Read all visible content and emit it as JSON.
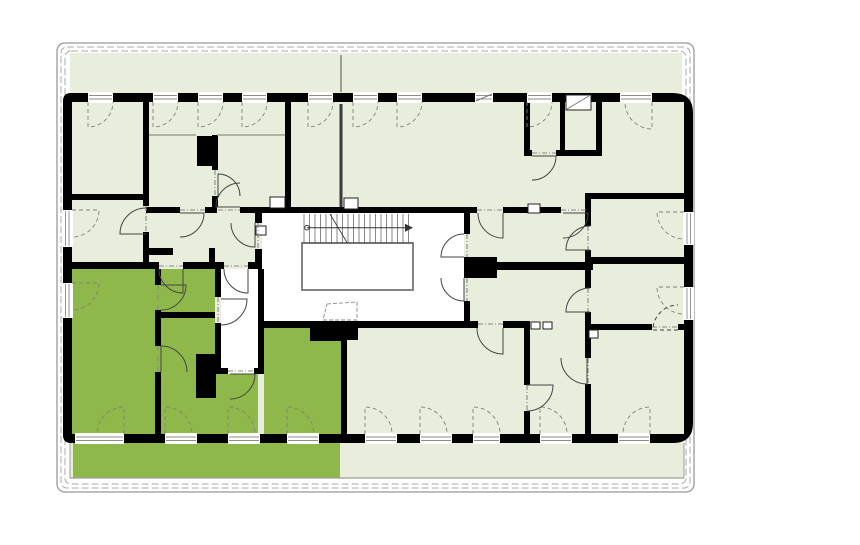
{
  "plan": {
    "canvas": {
      "w": 860,
      "h": 545
    },
    "colors": {
      "page_bg": "#ffffff",
      "room_fill": "#e9eedc",
      "highlight_fill": "#8fb84a",
      "wall": "#000000",
      "outline_gray": "#999999",
      "dash_gray": "#aaaaaa",
      "line_dark": "#444444",
      "window_arc": "#808080",
      "sill_gray": "#8a8a8a",
      "stair_line": "#555555",
      "well_stroke": "#777777",
      "terrace_line": "#9aa08f"
    },
    "outline": {
      "x": 57,
      "y": 43,
      "w": 637,
      "h": 449,
      "r": 8,
      "insets": [
        4,
        8
      ]
    },
    "bands": {
      "top": {
        "x": 70,
        "y": 53,
        "w": 612,
        "h": 40
      },
      "bottom": {
        "x": 70,
        "y": 443,
        "w": 614,
        "h": 35
      },
      "highlight_terrace": {
        "x": 73,
        "y": 443,
        "w": 267,
        "h": 35
      }
    },
    "shell": {
      "outer": {
        "x": 63,
        "y": 93,
        "w": 630,
        "h": 350,
        "r_left": 8,
        "r_right": 20
      },
      "inner": {
        "x": 72,
        "y": 102,
        "w": 612,
        "h": 332
      }
    },
    "white_regions": [
      [
        262,
        213,
        202,
        108
      ],
      [
        221,
        269,
        37,
        105
      ],
      [
        200,
        139,
        13,
        24
      ],
      [
        200,
        358,
        12,
        36
      ],
      [
        313,
        331,
        10,
        8
      ],
      [
        327,
        331,
        10,
        8
      ],
      [
        344,
        330,
        11,
        8
      ]
    ],
    "highlight_regions": [
      [
        72,
        269,
        143,
        165
      ],
      [
        215,
        374,
        43,
        60
      ],
      [
        264,
        328,
        77,
        106
      ]
    ],
    "walls": [
      [
        143,
        102,
        6,
        104
      ],
      [
        143,
        232,
        6,
        37
      ],
      [
        72,
        194,
        77,
        6
      ],
      [
        143,
        248,
        30,
        7
      ],
      [
        212,
        135,
        6,
        35
      ],
      [
        212,
        196,
        6,
        11
      ],
      [
        197,
        136,
        20,
        30
      ],
      [
        285,
        102,
        6,
        111
      ],
      [
        146,
        207,
        34,
        6
      ],
      [
        205,
        207,
        12,
        6
      ],
      [
        240,
        207,
        230,
        6
      ],
      [
        255,
        213,
        7,
        10
      ],
      [
        255,
        249,
        7,
        20
      ],
      [
        72,
        262,
        87,
        7
      ],
      [
        183,
        262,
        35,
        7
      ],
      [
        218,
        262,
        6,
        7
      ],
      [
        248,
        262,
        10,
        7
      ],
      [
        215,
        269,
        6,
        28
      ],
      [
        215,
        323,
        6,
        45
      ],
      [
        258,
        269,
        6,
        105
      ],
      [
        215,
        368,
        13,
        6
      ],
      [
        254,
        368,
        10,
        6
      ],
      [
        155,
        269,
        6,
        16
      ],
      [
        155,
        310,
        6,
        36
      ],
      [
        155,
        372,
        6,
        62
      ],
      [
        158,
        312,
        57,
        6
      ],
      [
        196,
        354,
        20,
        44
      ],
      [
        262,
        321,
        216,
        7
      ],
      [
        503,
        321,
        27,
        7
      ],
      [
        310,
        328,
        34,
        13
      ],
      [
        341,
        328,
        17,
        12
      ],
      [
        464,
        213,
        6,
        21
      ],
      [
        464,
        257,
        33,
        21
      ],
      [
        464,
        301,
        6,
        27
      ],
      [
        495,
        262,
        98,
        8
      ],
      [
        470,
        207,
        7,
        6
      ],
      [
        503,
        207,
        58,
        6
      ],
      [
        524,
        102,
        6,
        54
      ],
      [
        524,
        150,
        8,
        6
      ],
      [
        556,
        150,
        46,
        6
      ],
      [
        560,
        102,
        5,
        48
      ],
      [
        596,
        102,
        6,
        54
      ],
      [
        591,
        193,
        93,
        6
      ],
      [
        585,
        193,
        6,
        33
      ],
      [
        585,
        250,
        6,
        38
      ],
      [
        585,
        312,
        6,
        46
      ],
      [
        585,
        384,
        6,
        50
      ],
      [
        591,
        257,
        93,
        7
      ],
      [
        591,
        324,
        61,
        6
      ],
      [
        678,
        324,
        6,
        6
      ],
      [
        524,
        328,
        6,
        57
      ],
      [
        524,
        411,
        6,
        23
      ],
      [
        341,
        328,
        6,
        106
      ],
      [
        209,
        248,
        6,
        21
      ]
    ],
    "niches": [
      [
        270,
        197,
        15,
        11
      ],
      [
        344,
        198,
        14,
        11
      ],
      [
        528,
        204,
        12,
        9
      ],
      [
        531,
        322,
        9,
        7
      ],
      [
        543,
        322,
        9,
        7
      ],
      [
        589,
        330,
        9,
        8
      ],
      [
        256,
        226,
        10,
        9
      ],
      [
        566,
        95,
        25,
        15
      ]
    ],
    "windows": {
      "top": [
        [
          88,
          113,
          "l"
        ],
        [
          153,
          178,
          "l"
        ],
        [
          198,
          223,
          "l"
        ],
        [
          242,
          267,
          "l"
        ],
        [
          308,
          333,
          "l"
        ],
        [
          353,
          378,
          "l"
        ],
        [
          397,
          422,
          "l"
        ],
        [
          475,
          493,
          "none"
        ],
        [
          527,
          552,
          "l"
        ],
        [
          620,
          652,
          "r"
        ]
      ],
      "bottom": [
        [
          75,
          124,
          "r"
        ],
        [
          165,
          197,
          "l"
        ],
        [
          228,
          260,
          "l"
        ],
        [
          287,
          319,
          "l"
        ],
        [
          365,
          397,
          "l"
        ],
        [
          420,
          452,
          "l"
        ],
        [
          473,
          500,
          "l"
        ],
        [
          540,
          572,
          "l"
        ],
        [
          618,
          650,
          "r"
        ]
      ],
      "left": [
        [
          210,
          247,
          "t"
        ],
        [
          283,
          318,
          "t"
        ]
      ],
      "right": [
        [
          212,
          245,
          "t"
        ],
        [
          287,
          320,
          "t"
        ]
      ]
    },
    "doors": [
      [
        146,
        234,
        26,
        180,
        270,
        false
      ],
      [
        218,
        196,
        22,
        270,
        360,
        false
      ],
      [
        240,
        207,
        24,
        180,
        270,
        false
      ],
      [
        180,
        213,
        24,
        0,
        90,
        false
      ],
      [
        255,
        223,
        24,
        90,
        180,
        false
      ],
      [
        248,
        269,
        24,
        90,
        180,
        false
      ],
      [
        221,
        299,
        26,
        0,
        90,
        false
      ],
      [
        230,
        374,
        25,
        0,
        90,
        false
      ],
      [
        161,
        285,
        25,
        0,
        90,
        false
      ],
      [
        161,
        372,
        26,
        270,
        360,
        false
      ],
      [
        183,
        269,
        24,
        90,
        180,
        false
      ],
      [
        464,
        257,
        23,
        180,
        270,
        false
      ],
      [
        464,
        278,
        23,
        90,
        180,
        false
      ],
      [
        503,
        213,
        25,
        90,
        180,
        false
      ],
      [
        563,
        213,
        25,
        0,
        90,
        false
      ],
      [
        532,
        156,
        24,
        0,
        90,
        false
      ],
      [
        590,
        250,
        24,
        180,
        270,
        false
      ],
      [
        590,
        312,
        24,
        180,
        270,
        false
      ],
      [
        678,
        330,
        25,
        180,
        270,
        true
      ],
      [
        503,
        328,
        26,
        90,
        180,
        false
      ],
      [
        527,
        385,
        26,
        0,
        90,
        false
      ],
      [
        587,
        358,
        26,
        90,
        180,
        false
      ]
    ],
    "thresholds": [
      [
        146,
        206,
        146,
        232
      ],
      [
        215,
        170,
        215,
        196
      ],
      [
        218,
        210,
        240,
        210
      ],
      [
        180,
        210,
        205,
        210
      ],
      [
        258,
        223,
        258,
        249
      ],
      [
        224,
        266,
        248,
        266
      ],
      [
        218,
        297,
        218,
        323
      ],
      [
        228,
        371,
        254,
        371
      ],
      [
        158,
        285,
        158,
        310
      ],
      [
        158,
        346,
        158,
        372
      ],
      [
        159,
        266,
        183,
        266
      ],
      [
        467,
        234,
        467,
        257
      ],
      [
        467,
        278,
        467,
        301
      ],
      [
        477,
        210,
        503,
        210
      ],
      [
        561,
        210,
        587,
        210
      ],
      [
        532,
        153,
        556,
        153
      ],
      [
        588,
        226,
        588,
        250
      ],
      [
        588,
        288,
        588,
        312
      ],
      [
        652,
        327,
        678,
        327
      ],
      [
        478,
        324,
        503,
        324
      ],
      [
        527,
        385,
        527,
        411
      ],
      [
        588,
        358,
        588,
        384
      ]
    ],
    "stair": {
      "hatch": {
        "x0": 302,
        "x1": 413,
        "y0": 213,
        "y1": 243,
        "step": 5.5
      },
      "well": {
        "x": 302,
        "y": 243,
        "w": 111,
        "h": 47
      },
      "runner": {
        "x0": 307,
        "x1": 405,
        "y": 227.7
      },
      "diagonal": [
        330,
        214,
        347,
        242.5
      ],
      "trapezoid": [
        [
          327,
          304
        ],
        [
          357,
          302
        ],
        [
          357,
          320
        ],
        [
          323,
          320
        ]
      ]
    },
    "misc_lines": [
      {
        "p": [
          341,
          55,
          341,
          92
        ],
        "c": "#9aa08f",
        "w": 2
      },
      {
        "p": [
          341,
          104,
          341,
          207
        ],
        "c": "#3a3a3a",
        "w": 3
      },
      {
        "p": [
          149,
          135,
          196,
          135
        ],
        "c": "#9aa08f",
        "w": 1.5
      },
      {
        "p": [
          217,
          135,
          285,
          135
        ],
        "c": "#9aa08f",
        "w": 1.5
      },
      {
        "p": [
          70,
          478,
          684,
          478
        ],
        "c": "#9aa08f",
        "w": 1.2
      },
      {
        "p": [
          70,
          443,
          70,
          478
        ],
        "c": "#9aa08f",
        "w": 1
      },
      {
        "p": [
          684,
          443,
          684,
          478
        ],
        "c": "#9aa08f",
        "w": 1
      },
      {
        "p": [
          567,
          109,
          589,
          96
        ],
        "c": "#777777",
        "w": 1
      },
      {
        "p": [
          476,
          101,
          492,
          94
        ],
        "c": "#777777",
        "w": 1
      }
    ]
  }
}
